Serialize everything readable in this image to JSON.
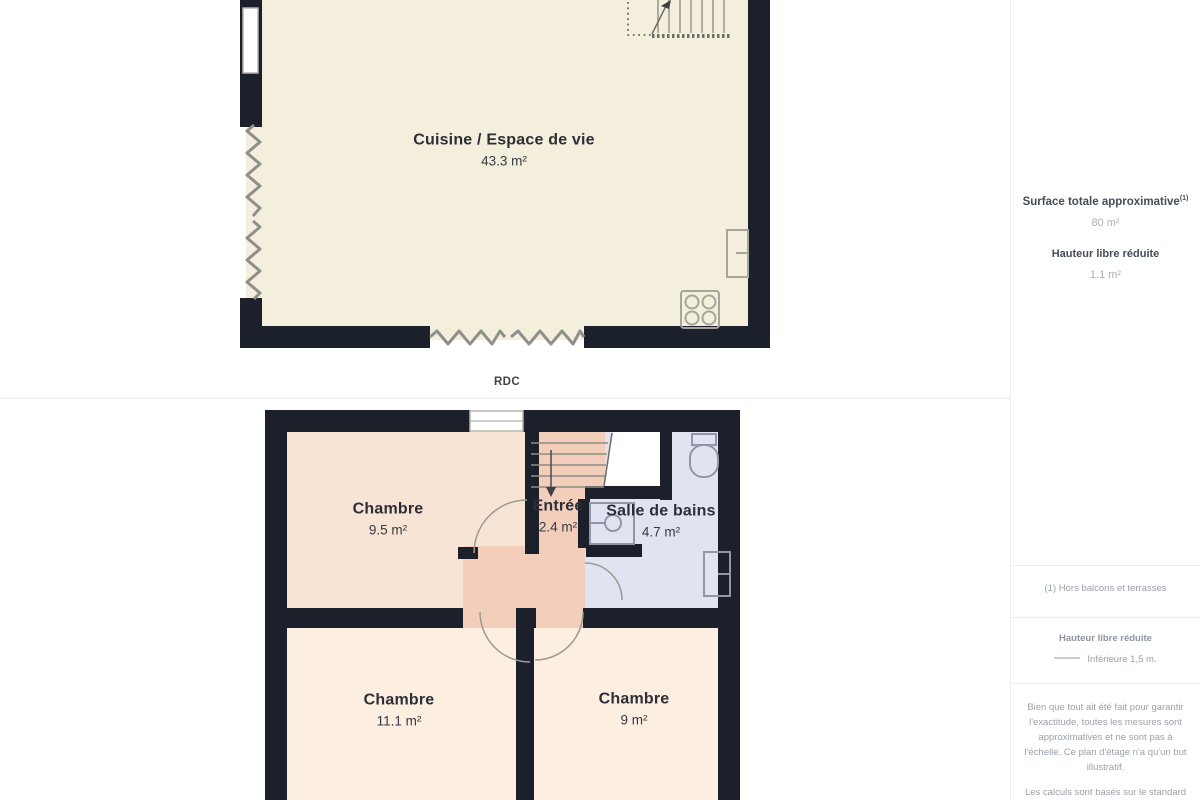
{
  "floor1": {
    "room_label": "Cuisine / Espace de vie",
    "room_area": "43.3 m²",
    "floor_label": "RDC"
  },
  "floor2": {
    "rooms": {
      "chambre1": {
        "label": "Chambre",
        "area": "9.5 m²"
      },
      "entree": {
        "label": "Entrée",
        "area": "2.4 m²"
      },
      "bains": {
        "label": "Salle de bains",
        "area": "4.7 m²"
      },
      "chambre2": {
        "label": "Chambre",
        "area": "11.1 m²"
      },
      "chambre3": {
        "label": "Chambre",
        "area": "9 m²"
      }
    }
  },
  "sidebar": {
    "surface_title": "Surface totale approximative",
    "surface_footnote_marker": "(1)",
    "surface_value": "80 m²",
    "reduced_height_title": "Hauteur libre réduite",
    "reduced_height_value": "1.1 m²",
    "footnote": "(1) Hors balcons et terrasses",
    "legend_title": "Hauteur libre réduite",
    "legend_item": "Inférieure 1,5 m.",
    "disclaimer_1": "Bien que tout ait été fait pour garantir l'exactitude, toutes les mesures sont approximatives et ne sont pas à l'échelle. Ce plan d'étage n'a qu'un but illustratif.",
    "disclaimer_2": "Les calculs sont basés sur le standard"
  },
  "colors": {
    "wall": "#1b202b",
    "floor_rdc": "#f3efdc",
    "floor_bedroom_top": "#f8e4d4",
    "floor_hall_entree": "#f3cfbb",
    "floor_bedroom_bottom": "#fcefe2",
    "floor_bathroom": "#e0e4f0",
    "reduced_height_zigzag": "#90908a",
    "sidebar_text_dark": "#454d57",
    "sidebar_text_light": "#9aa1ab"
  }
}
